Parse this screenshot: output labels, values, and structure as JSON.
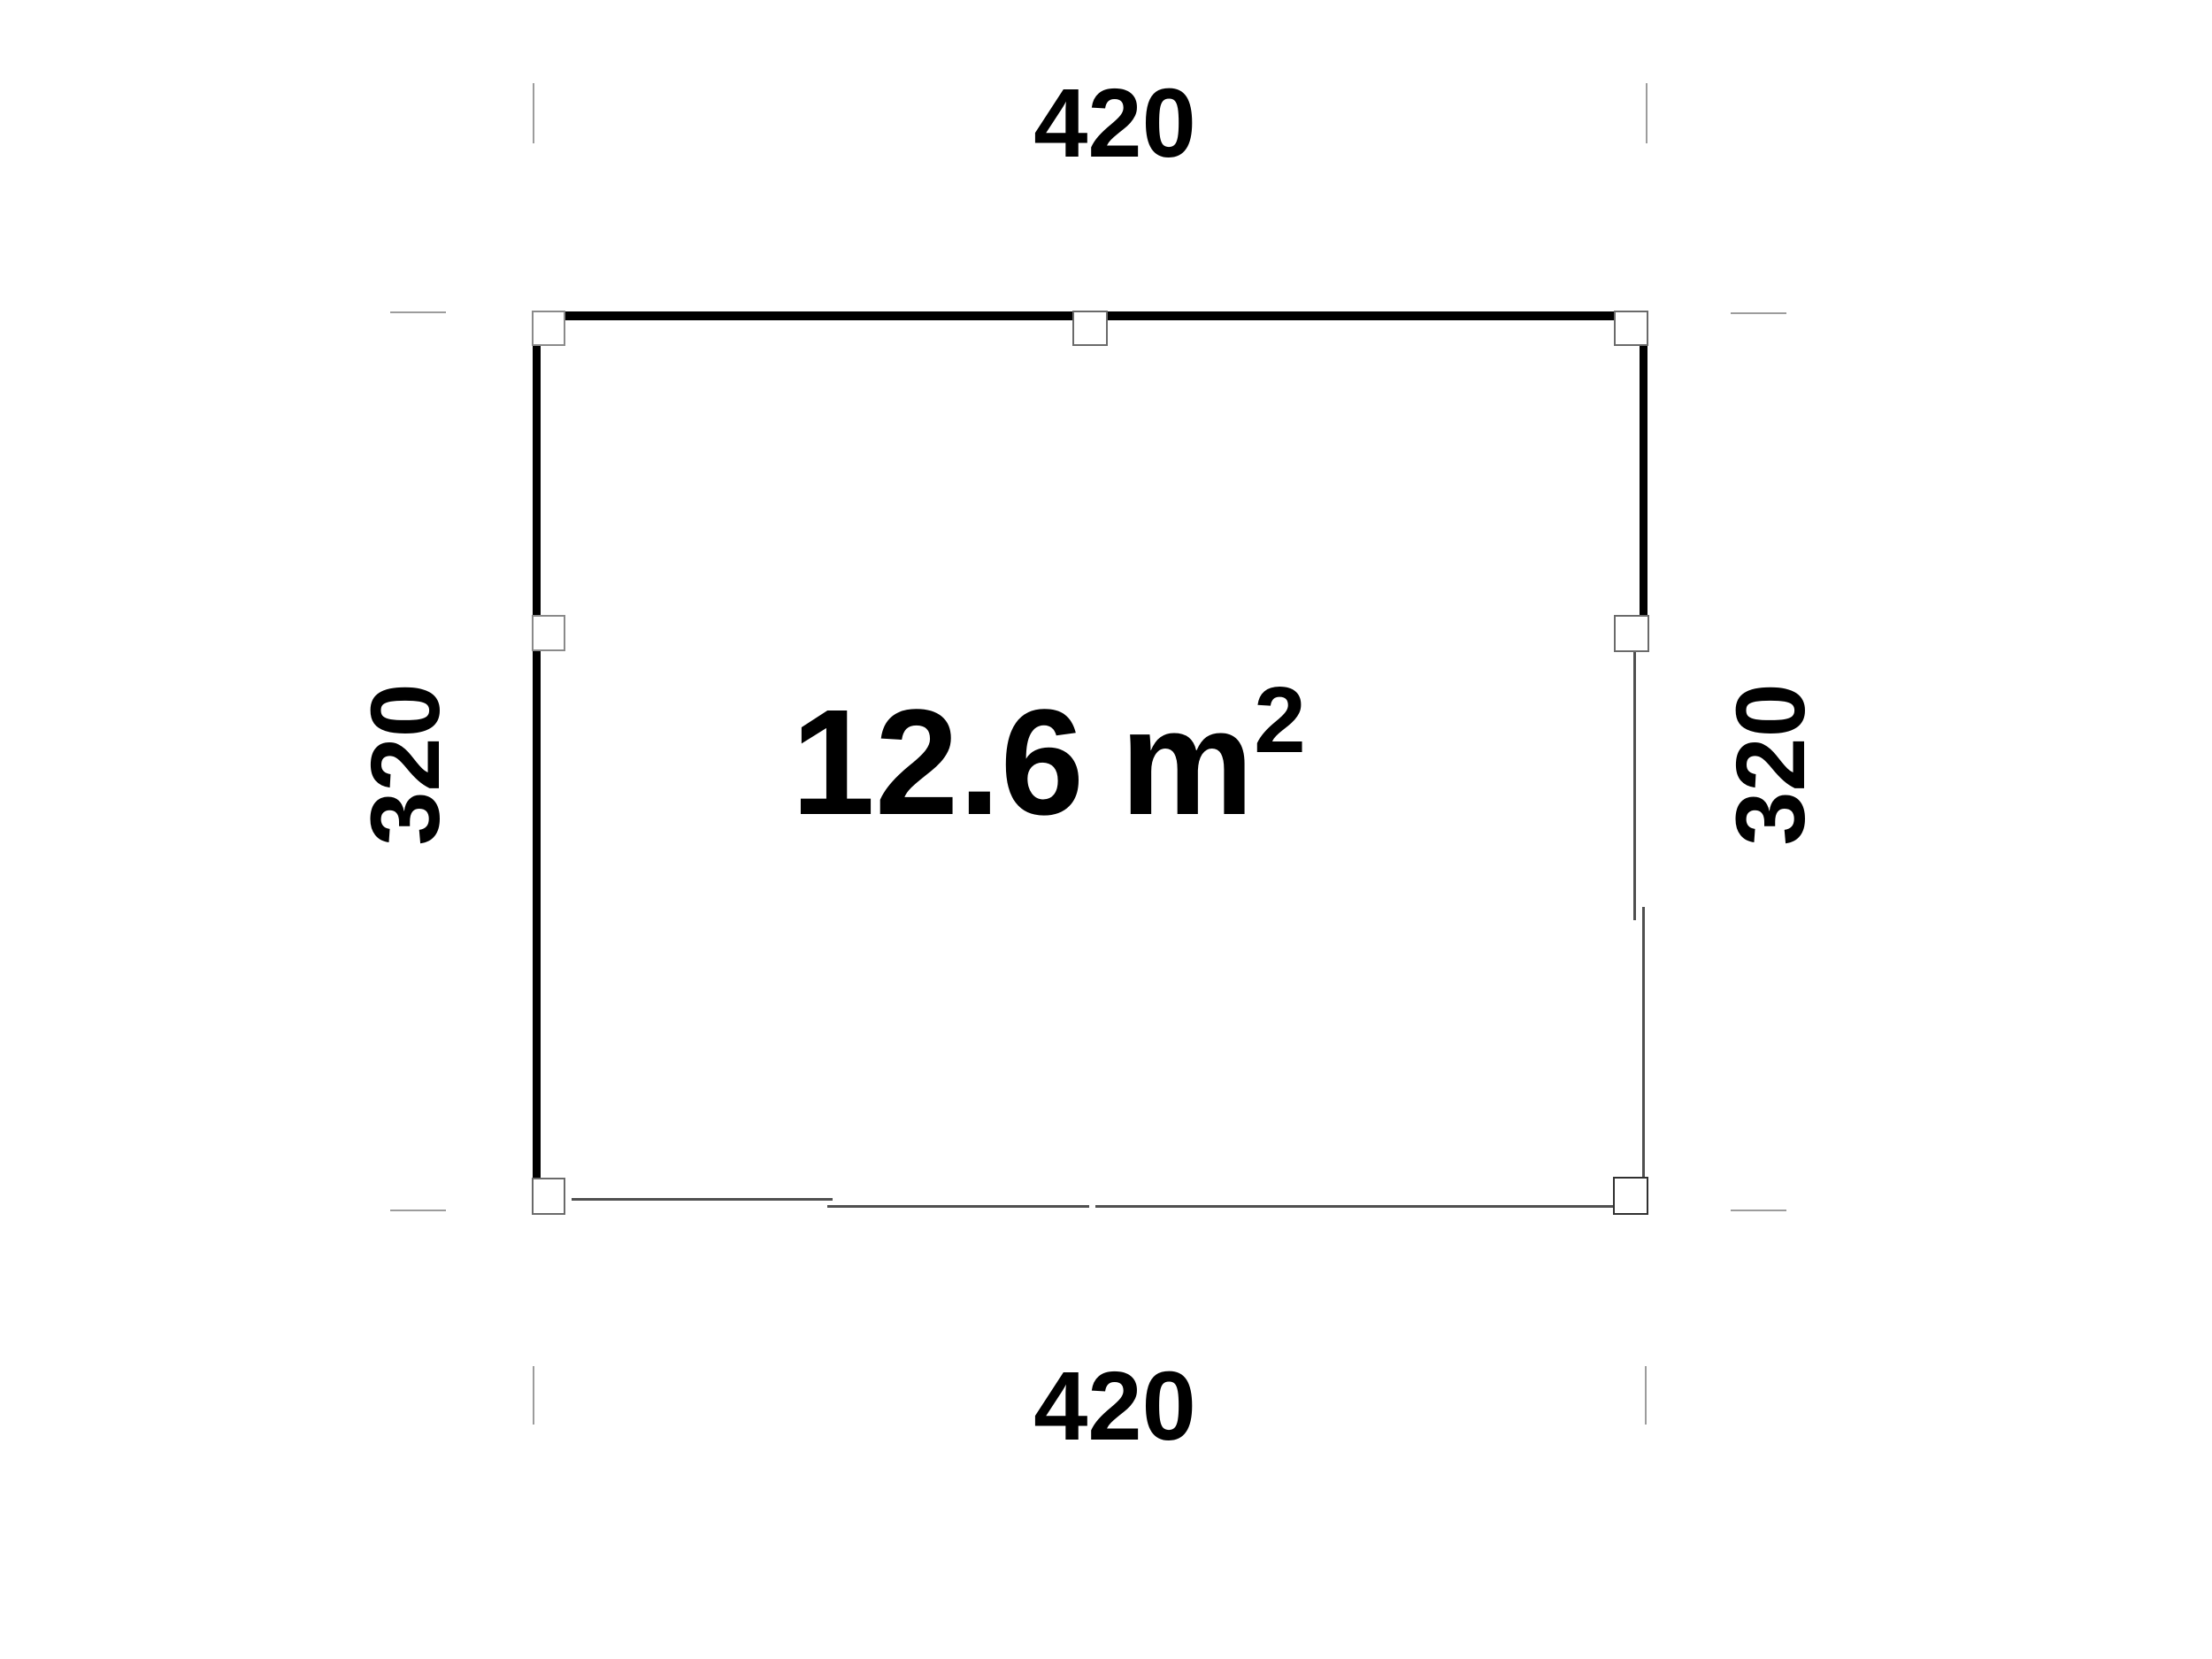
{
  "plan": {
    "area": {
      "value": "12.6",
      "unit": "m",
      "exponent": "2"
    },
    "dimensions": {
      "top": "420",
      "bottom": "420",
      "left": "320",
      "right": "320"
    }
  },
  "colors": {
    "background": "#ffffff",
    "wall": "#000000",
    "thin_line": "#4f4f4f",
    "extension_line": "#9c9c9c",
    "post_fill": "#ffffff",
    "post_border": "#6a6a6a",
    "text": "#000000"
  }
}
